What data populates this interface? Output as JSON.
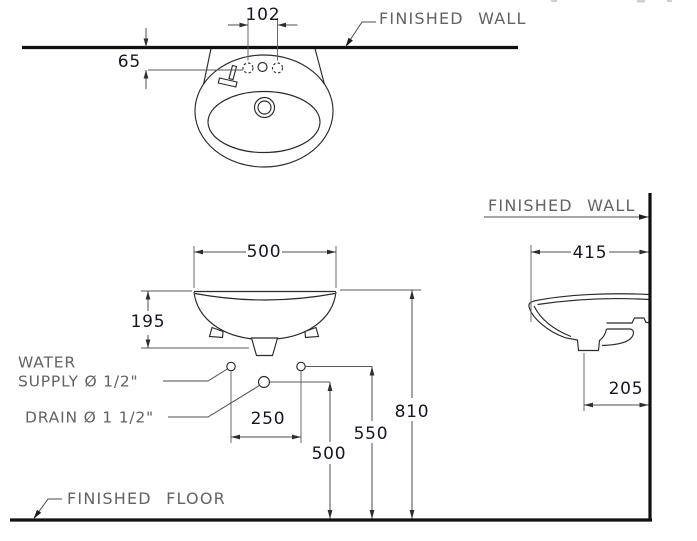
{
  "colors": {
    "background": "#ffffff",
    "heavy_line": "#101010",
    "object_line": "#2b2b2b",
    "dimension_line": "#4d4d4d",
    "label_text": "#636363",
    "number_text": "#16161f"
  },
  "views": {
    "plan": {
      "finished_wall_label": "FINISHED WALL",
      "dims": {
        "faucet_hole_spacing": "102",
        "holes_to_wall": "65"
      }
    },
    "front": {
      "water_supply_label_line1": "WATER",
      "water_supply_label_line2": "SUPPLY Ø 1/2\"",
      "drain_label": "DRAIN Ø 1 1/2\"",
      "finished_floor_label": "FINISHED FLOOR",
      "dims": {
        "basin_width": "500",
        "basin_height": "195",
        "supply_spacing": "250",
        "drain_height": "500",
        "supply_height": "550",
        "rim_height": "810"
      }
    },
    "side": {
      "finished_wall_label": "FINISHED WALL",
      "dims": {
        "basin_projection": "415",
        "drain_to_wall": "205"
      }
    }
  }
}
